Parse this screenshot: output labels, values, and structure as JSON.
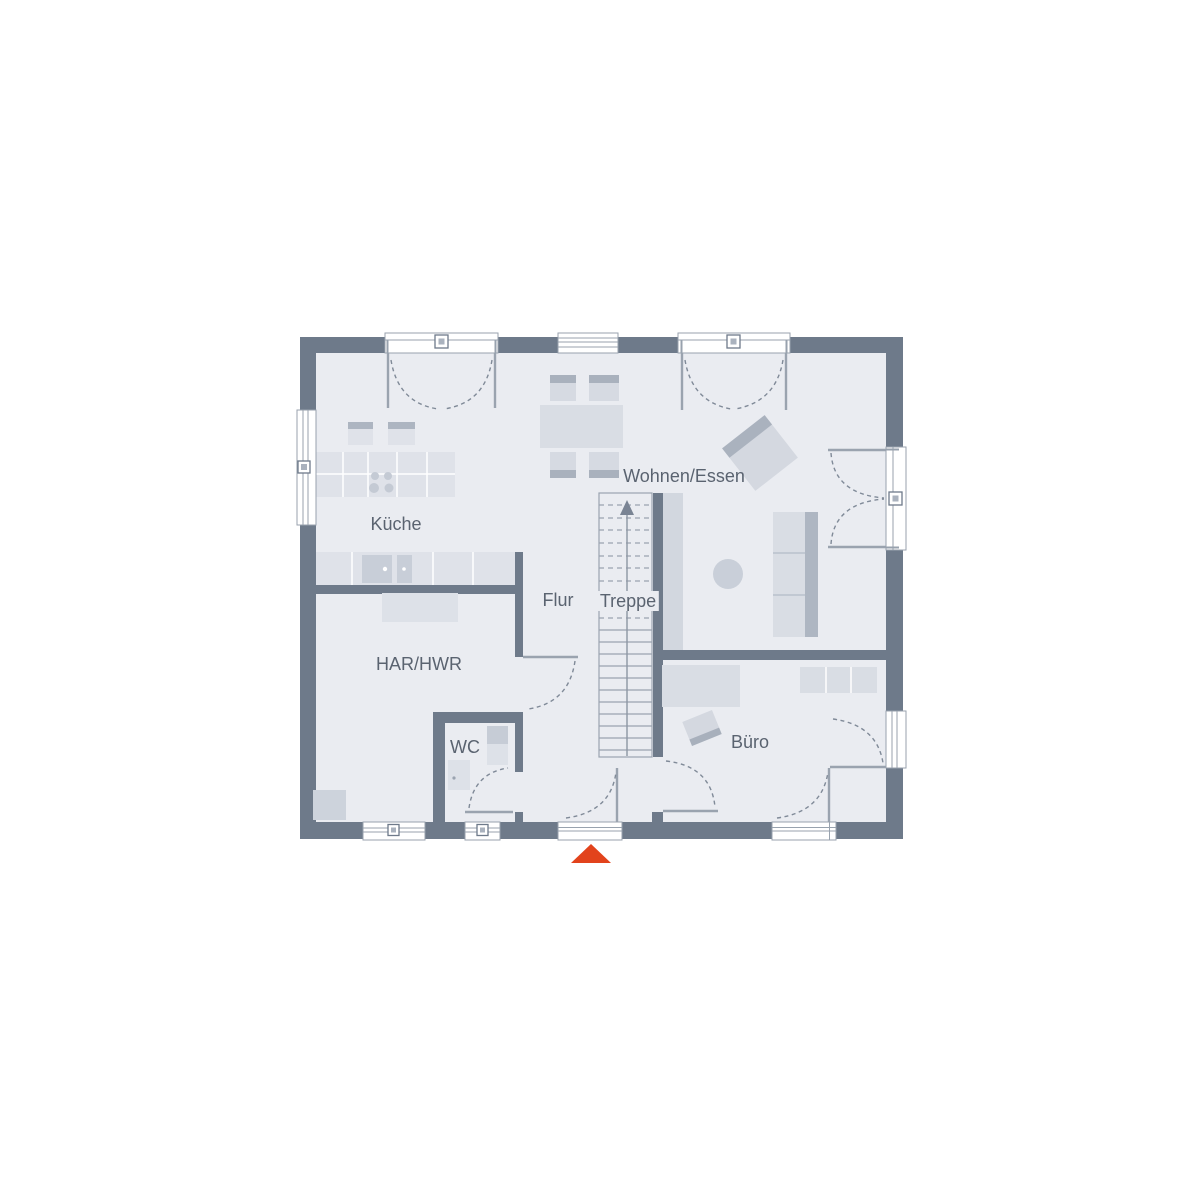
{
  "rooms": [
    {
      "name": "kueche",
      "label": "Küche"
    },
    {
      "name": "wohnen-essen",
      "label": "Wohnen/Essen"
    },
    {
      "name": "flur",
      "label": "Flur"
    },
    {
      "name": "treppe",
      "label": "Treppe"
    },
    {
      "name": "har-hwr",
      "label": "HAR/HWR"
    },
    {
      "name": "wc",
      "label": "WC"
    },
    {
      "name": "buero",
      "label": "Büro"
    }
  ],
  "colors": {
    "wall": "#6e7a8a",
    "floor": "#eaecf1",
    "furniture_light": "#dfe2e9",
    "furniture_medium": "#d5d9e1",
    "furniture_dark": "#adb5c1",
    "label_text": "#5a6370",
    "entrance_marker": "#e2431c"
  },
  "entrance_marker": {
    "shape": "triangle",
    "meaning": "entrance"
  }
}
